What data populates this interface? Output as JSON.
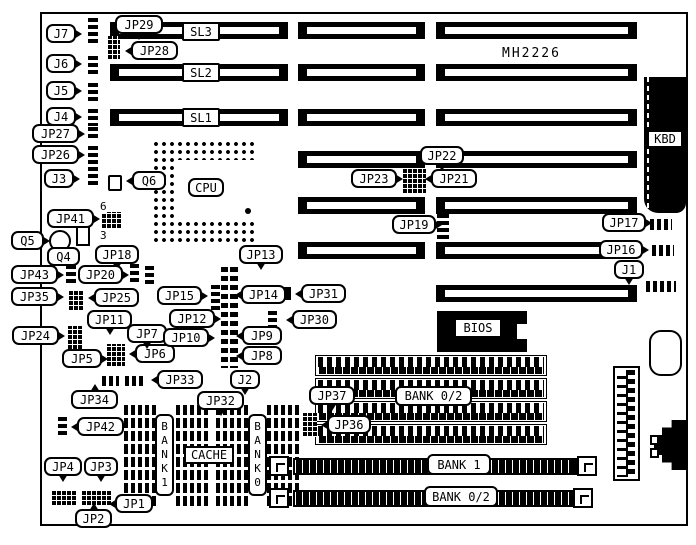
{
  "board": {
    "model": "MH2226"
  },
  "slots": {
    "sl1": "SL1",
    "sl2": "SL2",
    "sl3": "SL3"
  },
  "chips": {
    "cpu": "CPU",
    "bios": "BIOS",
    "cache": "CACHE",
    "kbd": "KBD"
  },
  "memory": {
    "bank02_top": "BANK 0/2",
    "bank1_row": "BANK 1",
    "bank02_bottom": "BANK 0/2",
    "bank1_col": "B\nA\nN\nK\n1",
    "bank0_col": "B\nA\nN\nK\n0"
  },
  "transistors": {
    "q4": "Q4",
    "q5": "Q5",
    "q6": "Q6"
  },
  "connectors": {
    "j1": "J1",
    "j2": "J2",
    "j3": "J3",
    "j4": "J4",
    "j5": "J5",
    "j6": "J6",
    "j7": "J7"
  },
  "pin_numbers": {
    "top": "6",
    "bottom": "3"
  },
  "jumpers": {
    "jp1": "JP1",
    "jp2": "JP2",
    "jp3": "JP3",
    "jp4": "JP4",
    "jp5": "JP5",
    "jp6": "JP6",
    "jp7": "JP7",
    "jp8": "JP8",
    "jp9": "JP9",
    "jp10": "JP10",
    "jp11": "JP11",
    "jp12": "JP12",
    "jp13": "JP13",
    "jp14": "JP14",
    "jp15": "JP15",
    "jp16": "JP16",
    "jp17": "JP17",
    "jp18": "JP18",
    "jp19": "JP19",
    "jp20": "JP20",
    "jp21": "JP21",
    "jp22": "JP22",
    "jp23": "JP23",
    "jp24": "JP24",
    "jp25": "JP25",
    "jp26": "JP26",
    "jp27": "JP27",
    "jp28": "JP28",
    "jp29": "JP29",
    "jp30": "JP30",
    "jp31": "JP31",
    "jp32": "JP32",
    "jp33": "JP33",
    "jp34": "JP34",
    "jp35": "JP35",
    "jp36": "JP36",
    "jp37": "JP37",
    "jp41": "JP41",
    "jp42": "JP42",
    "jp43": "JP43"
  }
}
